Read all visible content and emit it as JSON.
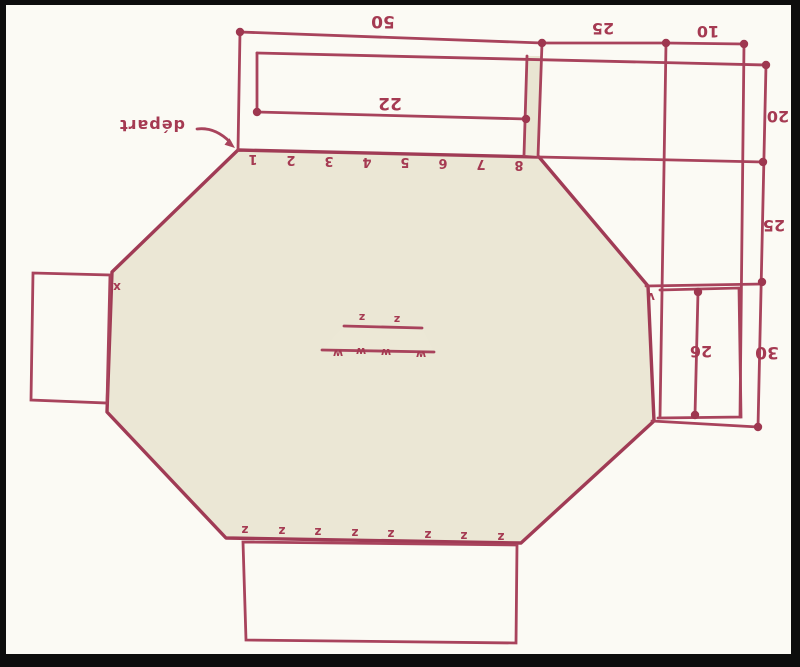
{
  "diagram_title": "octagon pattern working diagram",
  "start_label": "départ",
  "dimensions": {
    "top_50": "50",
    "top_25": "25",
    "top_10": "10",
    "inner_22": "22",
    "right_20": "20",
    "right_25": "25",
    "right_30": "30",
    "inner_26": "26"
  },
  "row_numbers": [
    "1",
    "2",
    "3",
    "4",
    "5",
    "6",
    "7",
    "8"
  ],
  "bottom_marks": [
    "z",
    "z",
    "z",
    "z",
    "z",
    "z",
    "z",
    "z"
  ],
  "center_marks": {
    "upper": [
      "z",
      "z"
    ],
    "lower": [
      "w",
      "w",
      "w",
      "w"
    ]
  },
  "edge_marks": {
    "left": "x",
    "right": "v"
  },
  "colors": {
    "ink": "#a8435c",
    "grid_line": "#c25a72",
    "octagon_fill": "#ebe7d5",
    "paper": "#fbfaf4",
    "flap_fill": "#fdfdf9",
    "frame": "#0d0d0d"
  }
}
